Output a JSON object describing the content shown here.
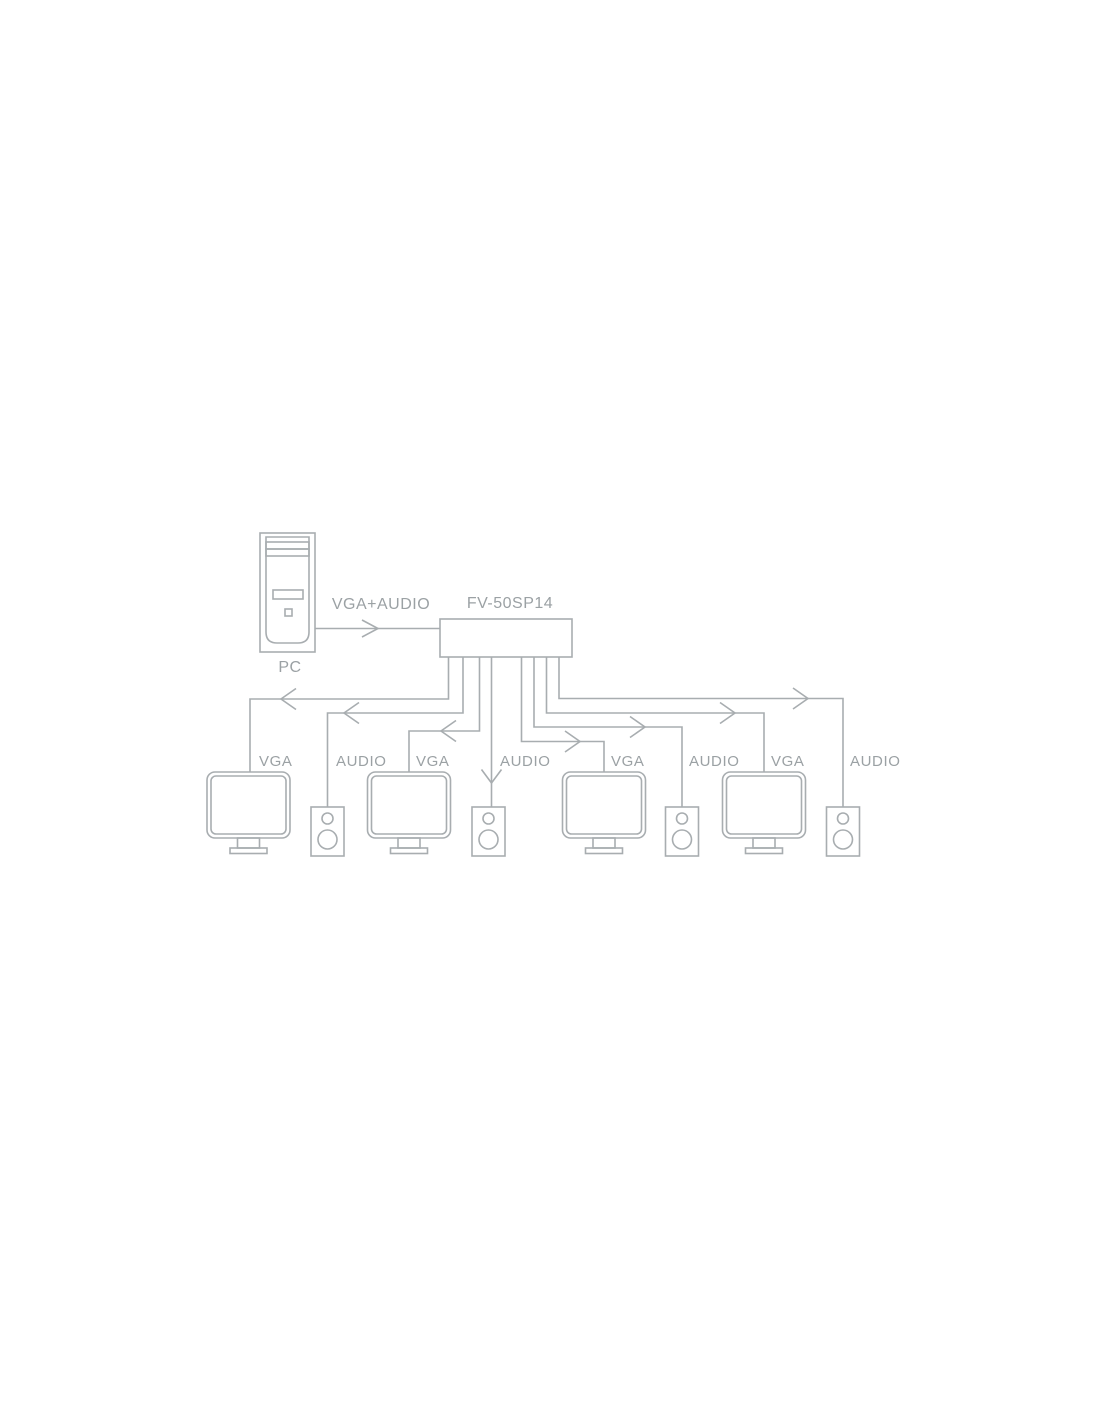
{
  "diagram": {
    "source": {
      "label": "PC"
    },
    "input_link": {
      "label": "VGA+AUDIO"
    },
    "splitter": {
      "model": "FV-50SP14"
    },
    "outputs": [
      {
        "device": "monitor",
        "label": "VGA"
      },
      {
        "device": "speaker",
        "label": "AUDIO"
      },
      {
        "device": "monitor",
        "label": "VGA"
      },
      {
        "device": "speaker",
        "label": "AUDIO"
      },
      {
        "device": "monitor",
        "label": "VGA"
      },
      {
        "device": "speaker",
        "label": "AUDIO"
      },
      {
        "device": "monitor",
        "label": "VGA"
      },
      {
        "device": "speaker",
        "label": "AUDIO"
      }
    ],
    "colors": {
      "line": "#a8adb0",
      "text": "#9ba1a4",
      "background": "#ffffff"
    }
  }
}
